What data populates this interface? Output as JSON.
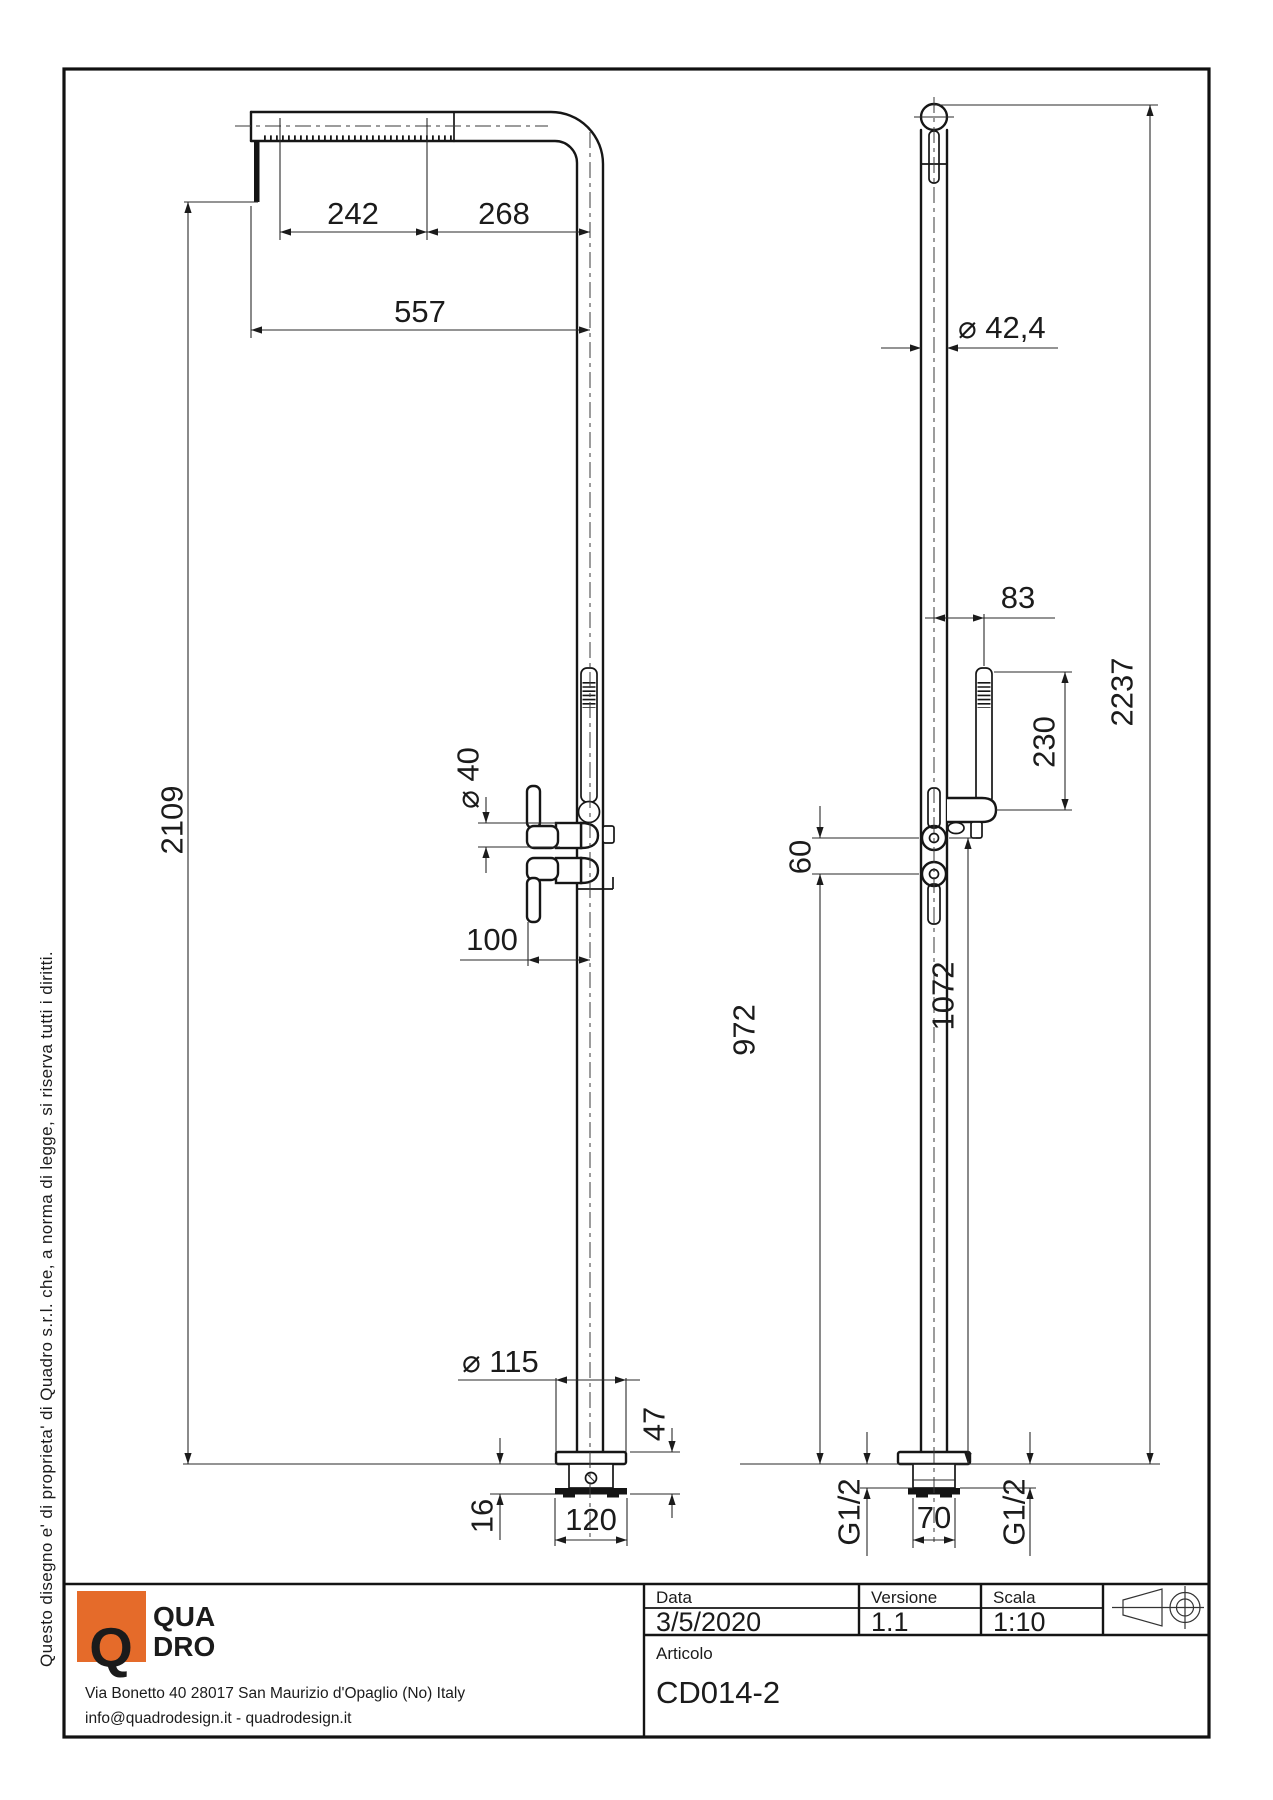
{
  "drawing": {
    "copyright": "Questo disegno e' di proprieta' di Quadro s.r.l. che, a norma di legge, si riserva tutti i diritti.",
    "dims": {
      "d242": "242",
      "d268": "268",
      "d557": "557",
      "d2109": "2109",
      "dia40": "⌀ 40",
      "d100": "100",
      "dia115": "⌀ 115",
      "d16": "16",
      "d47": "47",
      "d120": "120",
      "dia424": "⌀ 42,4",
      "d83": "83",
      "d230": "230",
      "d2237": "2237",
      "d60": "60",
      "d972": "972",
      "d1072": "1072",
      "d70": "70",
      "g12_left": "G1/2",
      "g12_right": "G1/2"
    }
  },
  "title_block": {
    "logo": {
      "q": "Q",
      "line1": "QUA",
      "line2": "DRO",
      "color": "#e56b2a"
    },
    "address_line1": "Via Bonetto 40  28017 San Maurizio d'Opaglio (No) Italy",
    "address_line2": "info@quadrodesign.it  -  quadrodesign.it",
    "fields": {
      "data_label": "Data",
      "data_value": "3/5/2020",
      "versione_label": "Versione",
      "versione_value": "1.1",
      "scala_label": "Scala",
      "scala_value": "1:10",
      "articolo_label": "Articolo",
      "articolo_value": "CD014-2"
    }
  }
}
